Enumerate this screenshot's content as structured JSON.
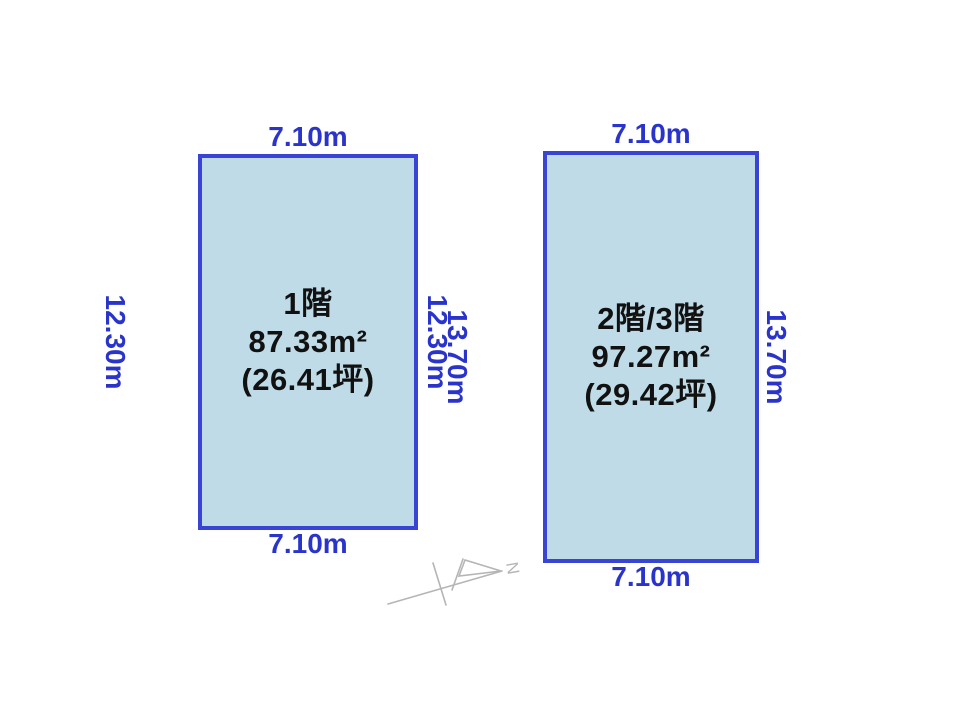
{
  "diagram": {
    "title": "floor-plan-areas",
    "plots": [
      {
        "id": "first-floor",
        "floor_label": "1階",
        "area_sqm": "87.33m²",
        "area_tsubo": "(26.41坪)",
        "width_top": "7.10m",
        "width_bottom": "7.10m",
        "height_left": "12.30m",
        "height_right": "12.30m"
      },
      {
        "id": "second-third-floor",
        "floor_label": "2階/3階",
        "area_sqm": "97.27m²",
        "area_tsubo": "(29.42坪)",
        "width_top": "7.10m",
        "width_bottom": "7.10m",
        "height_left": "13.70m",
        "height_right": "13.70m"
      }
    ],
    "north_arrow": {
      "label": "N"
    },
    "colors": {
      "background": "#ffffff",
      "rect_fill": "#bfdbe7",
      "rect_border": "#3a44d4",
      "dimension_text": "#2a34ca",
      "floor_text": "#111111",
      "north_arrow_stroke": "#b5b5b5"
    }
  }
}
